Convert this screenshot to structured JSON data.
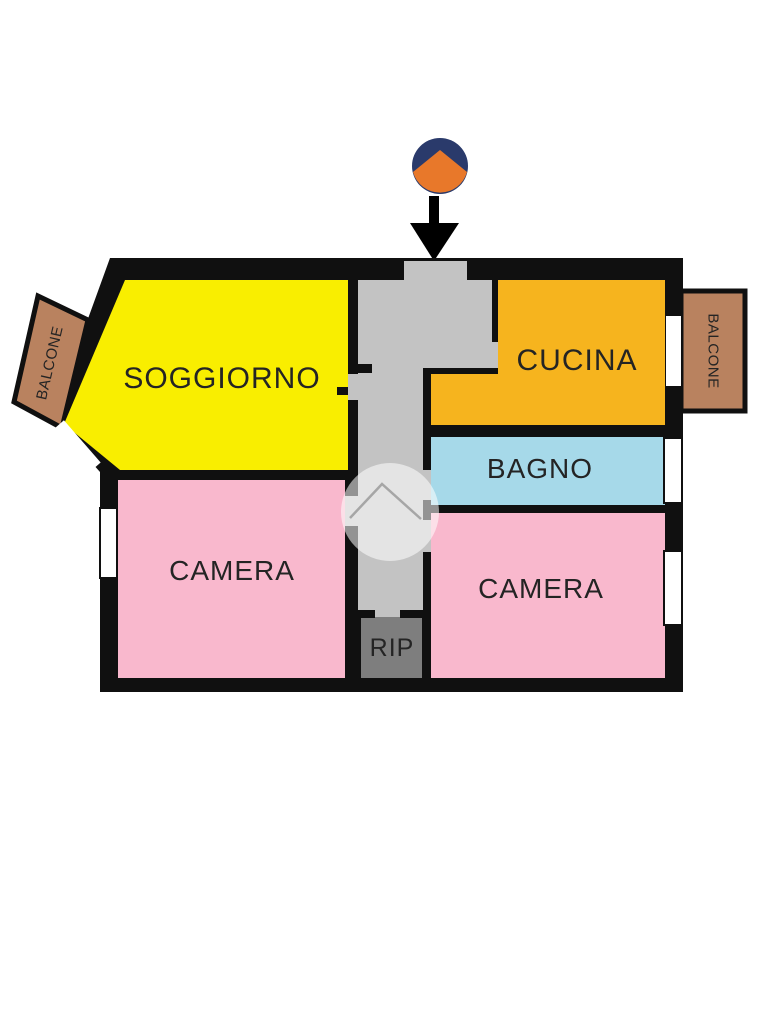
{
  "canvas": {
    "width": 768,
    "height": 1024,
    "background": "#ffffff"
  },
  "palette": {
    "wall": "#101010",
    "corridor": "#c3c3c3",
    "window": "#ffffff",
    "label": "#242424",
    "watermark_fill": "#ffffff",
    "watermark_line": "#9b9b9b",
    "arrow": "#000000"
  },
  "entrance_marker": {
    "circle_top_color": "#2a3a6b",
    "circle_bottom_color": "#e8782a"
  },
  "rooms": {
    "soggiorno": {
      "label": "SOGGIORNO",
      "color": "#f9ee00"
    },
    "cucina": {
      "label": "CUCINA",
      "color": "#f6b41e"
    },
    "bagno": {
      "label": "BAGNO",
      "color": "#a6d9e9"
    },
    "camera_sx": {
      "label": "CAMERA",
      "color": "#f9b8cd"
    },
    "camera_dx": {
      "label": "CAMERA",
      "color": "#f9b8cd"
    },
    "ripostiglio": {
      "label": "RIP",
      "color": "#7e7e7e"
    },
    "balcone_sx": {
      "label": "BALCONE",
      "color": "#b9825f"
    },
    "balcone_dx": {
      "label": "BALCONE",
      "color": "#b9825f"
    }
  }
}
